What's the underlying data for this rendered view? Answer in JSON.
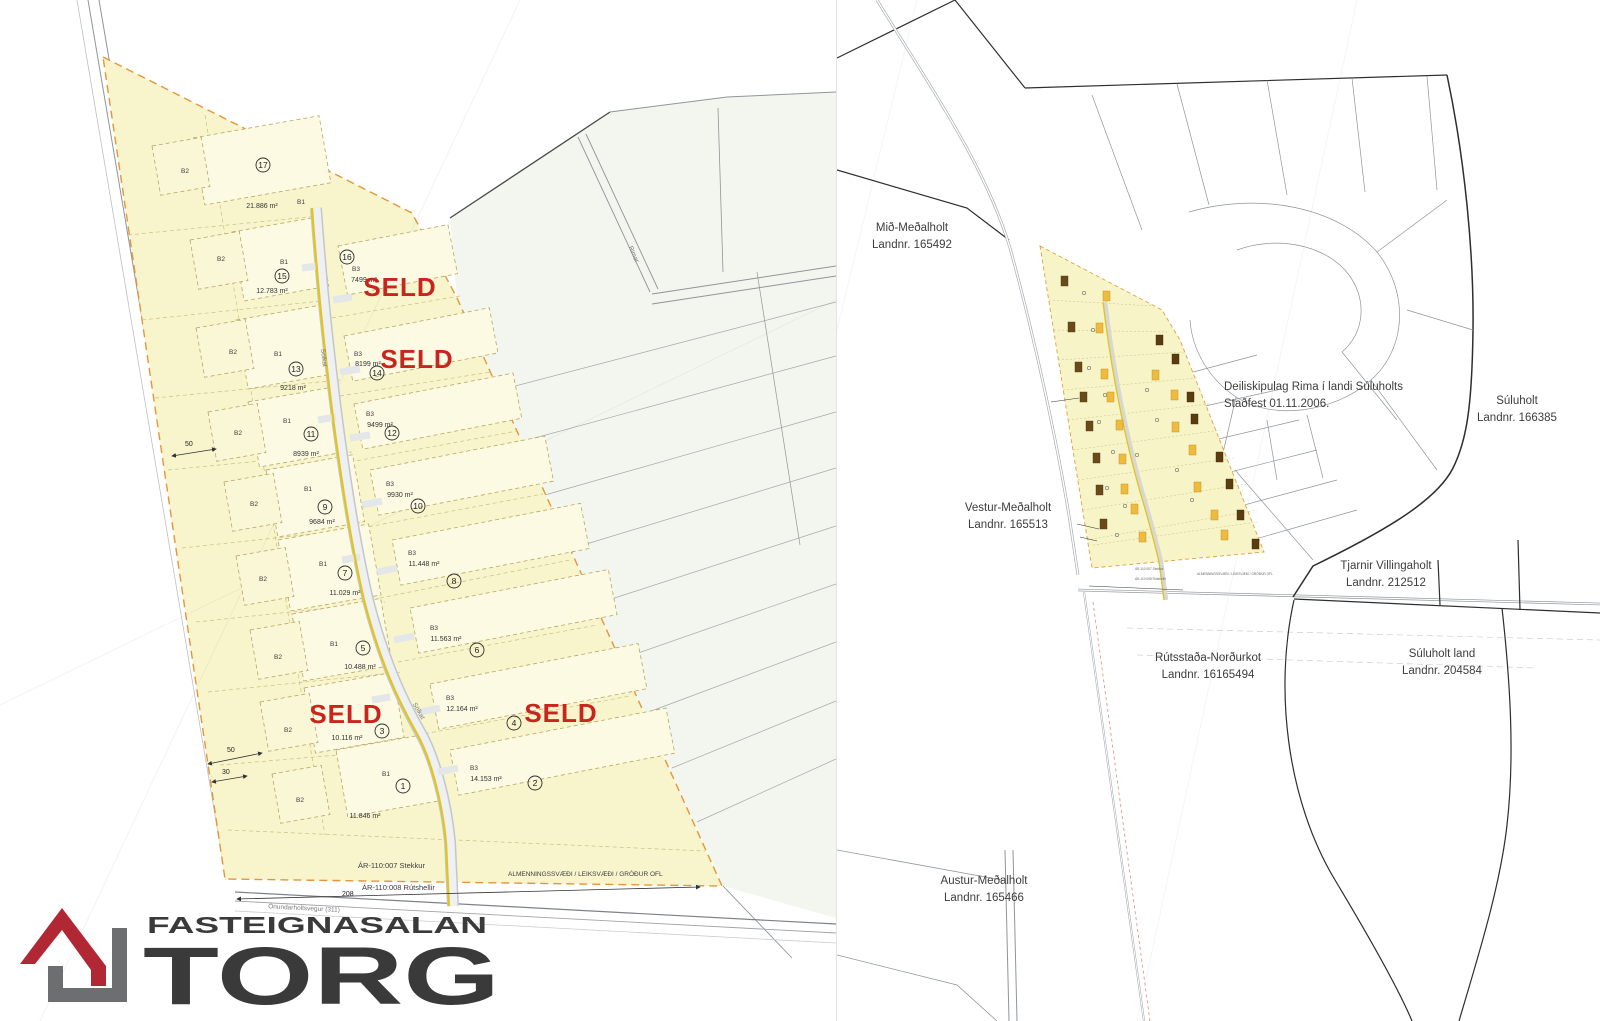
{
  "logo": {
    "brand_top": "FASTEIGNASALAN",
    "brand_main": "TORG"
  },
  "colors": {
    "seld_red": "#c8251c",
    "logo_red": "#b22734",
    "logo_gray": "#6e6e70",
    "plan_fill": "#f8f5cc",
    "plan_boundary_orange": "#e2973a",
    "road_stripe_yellow": "#e3c41a",
    "building_brown": "#6b4a1a",
    "building_yellow": "#eebb3d"
  },
  "left_map": {
    "seld": "SELD",
    "b1": "B1",
    "b2": "B2",
    "b3": "B3",
    "roads": {
      "west": "Gaulverjabæjarvegur (33)",
      "south": "Önundarholtsvegur (311)",
      "central": "Sölkat",
      "neighbor": "Rimar"
    },
    "dims": {
      "d50a": "50",
      "d50b": "50",
      "d30": "30",
      "d208": "208"
    },
    "notes": {
      "stekkur": "ÁR-110:007 Stekkur",
      "rutshellir": "ÁR-110:008 Rútshellir",
      "common": "ALMENNINGSSVÆÐI / LEIKSVÆÐI / GRÓÐUR OFL"
    },
    "lots_odd": [
      {
        "num": "17",
        "area": "21.886 m²"
      },
      {
        "num": "15",
        "area": "12.783 m²"
      },
      {
        "num": "13",
        "area": "9218 m²"
      },
      {
        "num": "11",
        "area": "8939 m²"
      },
      {
        "num": "9",
        "area": "9684 m²"
      },
      {
        "num": "7",
        "area": "11.029 m²"
      },
      {
        "num": "5",
        "area": "10.488 m²"
      },
      {
        "num": "3",
        "area": "10.116 m²"
      },
      {
        "num": "1",
        "area": "11.846 m²"
      }
    ],
    "lots_even": [
      {
        "num": "16",
        "area": "7499 m²"
      },
      {
        "num": "14",
        "area": "8199 m²"
      },
      {
        "num": "12",
        "area": "9499 m²"
      },
      {
        "num": "10",
        "area": "9930 m²"
      },
      {
        "num": "8",
        "area": "11.448 m²"
      },
      {
        "num": "6",
        "area": "11.563 m²"
      },
      {
        "num": "4",
        "area": "12.164 m²"
      },
      {
        "num": "2",
        "area": "14.153 m²"
      }
    ]
  },
  "right_map": {
    "plan_note_line1": "Deiliskipulag Rima í landi Súluholts",
    "plan_note_line2": "Staðfest 01.11.2006.",
    "parcels": [
      {
        "name": "Mið-Meðalholt",
        "landnr": "Landnr. 165492"
      },
      {
        "name": "Vestur-Meðalholt",
        "landnr": "Landnr. 165513"
      },
      {
        "name": "Austur-Meðalholt",
        "landnr": "Landnr. 165466"
      },
      {
        "name": "Rútsstaða-Norðurkot",
        "landnr": "Landnr. 16165494"
      },
      {
        "name": "Súluholt",
        "landnr": "Landnr. 166385"
      },
      {
        "name": "Tjarnir Villingaholt",
        "landnr": "Landnr. 212512"
      },
      {
        "name": "Súluholt land",
        "landnr": "Landnr. 204584"
      }
    ]
  }
}
